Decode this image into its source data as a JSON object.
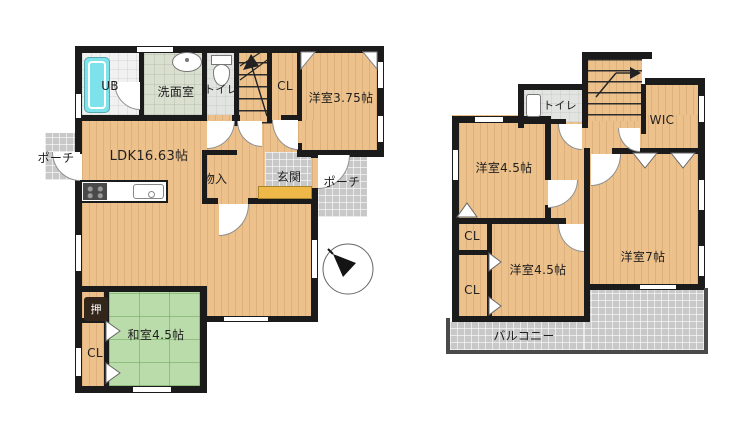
{
  "plan_type": "floorplan",
  "colors": {
    "wall": "#1b1b1b",
    "wood_floor": "#ecc18c",
    "tatami_floor": "#b9dcaa",
    "tile_floor": "#c8c8c8",
    "washroom_floor": "#d9e0cf",
    "toilet_floor": "#e1e4e1",
    "bathroom_floor": "#f1f1f1",
    "bathtub": "#7de2ea",
    "entry_step": "#efb94a"
  },
  "floor1": {
    "labels": {
      "ub": "UB",
      "washroom": "洗面室",
      "toilet": "トイレ",
      "closet_hall": "CL",
      "western_room": "洋室3.75帖",
      "ldk": "LDK16.63帖",
      "storage": "物入",
      "entrance": "玄関",
      "porch_east": "ポーチ",
      "porch_west": "ポーチ",
      "japanese_room": "和室4.5帖",
      "oshiire": "押",
      "closet_washitsu": "CL"
    }
  },
  "floor2": {
    "labels": {
      "toilet": "トイレ",
      "wic": "WIC",
      "western_room_north": "洋室4.5帖",
      "western_room_east": "洋室7帖",
      "closet_upper": "CL",
      "closet_lower": "CL",
      "western_room_south": "洋室4.5帖",
      "balcony": "バルコニー"
    }
  }
}
